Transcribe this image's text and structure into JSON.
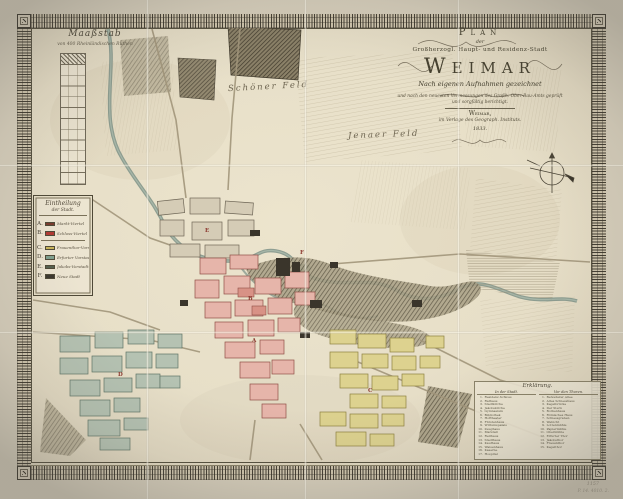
{
  "cartouche": {
    "plan_label": "Plan",
    "der": "der",
    "line3": "Großherzogl. Haupt- und Residenz-Stadt",
    "title": "Weimar",
    "line5": "Nach eigenen Aufnahmen gezeichnet",
    "line6": "und nach den neuesten Vermessungen des Großh. Ober-Bau-Amts geprüft",
    "line7": "und sorgfältig berichtigt.",
    "place": "Weimar,",
    "publisher": "im Verlage des Geograph. Instituts.",
    "year": "1833.",
    "swash_left": "⌇",
    "swash_right": "⌇"
  },
  "scale_bar": {
    "title": "Maaßstab",
    "subtitle": "von 400 Rheinländischen Ruthen"
  },
  "legend": {
    "heading_line1": "Eintheilung",
    "heading_line2": "der Stadt.",
    "entries": [
      {
        "letter": "A",
        "color": "#7a3b2e",
        "label": "Markt-Viertel"
      },
      {
        "letter": "B",
        "color": "#b23a34",
        "label": "Schloss-Viertel"
      },
      {
        "letter": "C",
        "color": "#c9b55b",
        "label": "Frauenthor-Vorstadt"
      },
      {
        "letter": "D",
        "color": "#7f9f8e",
        "label": "Erfurter Vorstadt"
      },
      {
        "letter": "E",
        "color": "#55604f",
        "label": "Jakobs-Vorstadt"
      },
      {
        "letter": "F",
        "color": "#3c382f",
        "label": "Neue Stadt"
      }
    ],
    "divider_after": 1
  },
  "fields": [
    {
      "label": "Schöner Feld"
    },
    {
      "label": "Jenaer Feld"
    }
  ],
  "index": {
    "heading": "Erklärung.",
    "col1_heading": "In der Stadt.",
    "col2_heading": "Vor den Thoren.",
    "col1": [
      "Residenz-Schloss",
      "Rathaus",
      "Stadtkirche",
      "Jakobskirche",
      "Gymnasium",
      "Bibliothek",
      "Hoftheater",
      "Fürstenhaus",
      "Wittumspalais",
      "Zeughaus",
      "Marstall",
      "Reithaus",
      "Stadthaus",
      "Kaufhaus",
      "Waisenhaus",
      "Kaserne",
      "Hospital"
    ],
    "col2": [
      "Belvederer Allee",
      "Altes Schiesshaus",
      "Kegelbrücke",
      "Der Stern",
      "Borkenhaus",
      "Römisches Haus",
      "Schiessgraben",
      "Webicht",
      "Lottenmühle",
      "Papiermühle",
      "Obermühle",
      "Erfurter Thor",
      "Jakobsthor",
      "Frauenthor",
      "Kegelthor"
    ]
  },
  "map_letters": [
    {
      "letter": "A",
      "x": 252,
      "y": 338
    },
    {
      "letter": "B",
      "x": 248,
      "y": 296
    },
    {
      "letter": "C",
      "x": 368,
      "y": 388
    },
    {
      "letter": "D",
      "x": 118,
      "y": 372
    },
    {
      "letter": "E",
      "x": 205,
      "y": 228
    },
    {
      "letter": "F",
      "x": 300,
      "y": 250
    }
  ],
  "margin_notes": {
    "line1": "1157",
    "line2": "P. 14. 4010. 2."
  },
  "colors": {
    "quarter_pink": "#e6b5aa",
    "quarter_yellow": "#ddd28f",
    "quarter_teal": "#b5c2b2",
    "river": "#7e9287",
    "ink": "#4a4436"
  }
}
